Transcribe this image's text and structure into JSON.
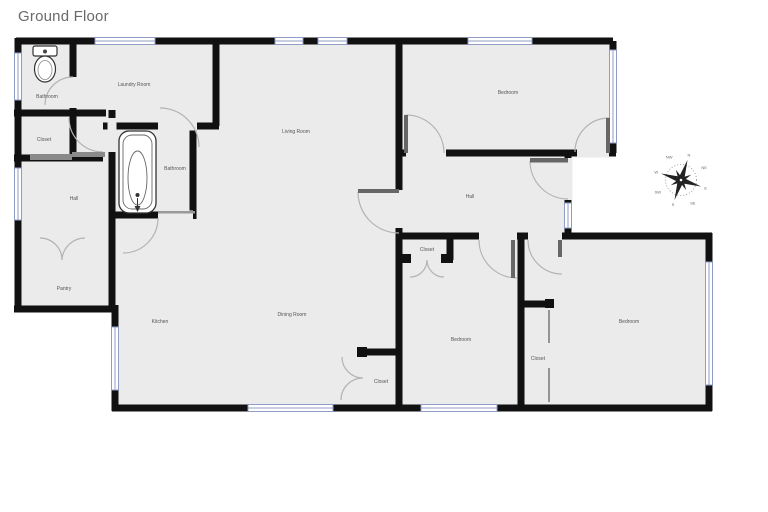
{
  "page": {
    "title": "Ground Floor"
  },
  "floorplan": {
    "colors": {
      "wall": "#111111",
      "floor": "#ebebeb",
      "window_frame": "#8f9cc5",
      "door_arc": "#b3b3b3",
      "door_leaf": "#666666",
      "label_text": "#555555",
      "title_text": "#6a6a6a"
    },
    "rooms": [
      {
        "id": "bathroom-upper",
        "label": "Bathroom"
      },
      {
        "id": "laundry-room",
        "label": "Laundry Room"
      },
      {
        "id": "closet-upper",
        "label": "Closet"
      },
      {
        "id": "hall-left",
        "label": "Hall"
      },
      {
        "id": "bathroom-main",
        "label": "Bathroom"
      },
      {
        "id": "living-room",
        "label": "Living Room"
      },
      {
        "id": "bedroom-ne",
        "label": "Bedroom"
      },
      {
        "id": "hall-right",
        "label": "Hall"
      },
      {
        "id": "closet-hall",
        "label": "Closet"
      },
      {
        "id": "pantry",
        "label": "Pantry"
      },
      {
        "id": "kitchen",
        "label": "Kitchen"
      },
      {
        "id": "dining-room",
        "label": "Dining Room"
      },
      {
        "id": "bedroom-south",
        "label": "Bedroom"
      },
      {
        "id": "closet-dining",
        "label": "Closet"
      },
      {
        "id": "bedroom-se",
        "label": "Bedroom"
      },
      {
        "id": "closet-se",
        "label": "Closet"
      }
    ],
    "fixtures": [
      "toilet",
      "bathtub"
    ],
    "compass": {
      "directions": [
        "N",
        "NE",
        "E",
        "SE",
        "S",
        "SW",
        "W",
        "NW"
      ]
    }
  }
}
